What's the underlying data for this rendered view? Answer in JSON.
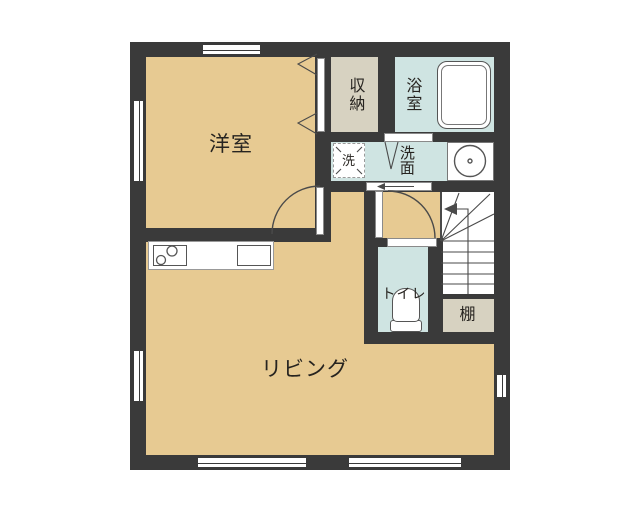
{
  "labels": {
    "western_room": "洋室",
    "storage": "収納",
    "bathroom": "浴室",
    "washer": "洗",
    "washroom": "洗面",
    "living": "リビング",
    "toilet": "トイレ",
    "shelf": "棚"
  },
  "colors": {
    "wall": "#3a3a3a",
    "tan": "#e7ca92",
    "blue": "#cfe4e2",
    "beige": "#d7d2c1",
    "line": "#4a4a4a",
    "text": "#272420"
  }
}
